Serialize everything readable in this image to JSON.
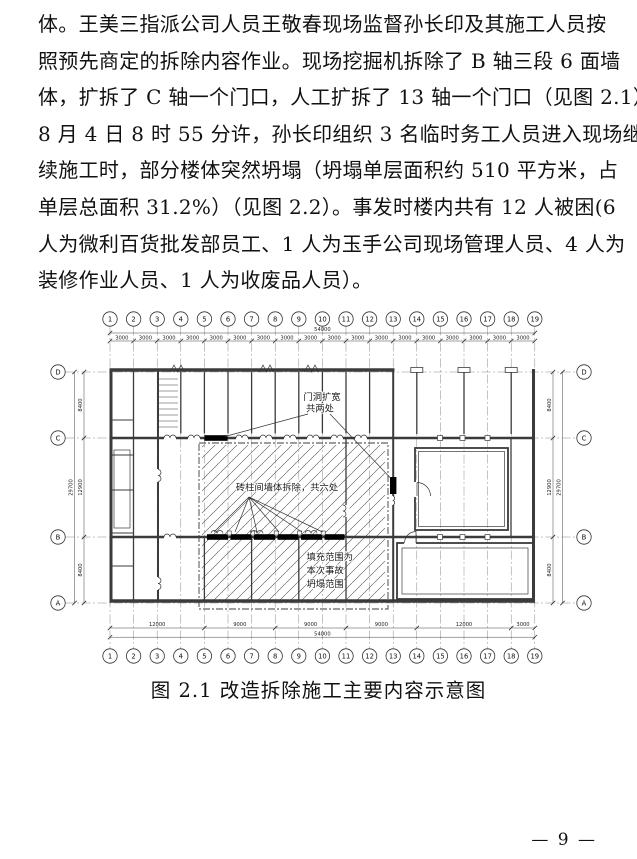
{
  "page": {
    "body_lines": [
      "体。王美三指派公司人员王敬春现场监督孙长印及其施工人员按",
      "照预先商定的拆除内容作业。现场挖掘机拆除了 B 轴三段 6 面墙",
      "体，扩拆了 C 轴一个门口，人工扩拆了 13 轴一个门口（见图 2.1）。",
      "8 月 4 日 8 时 55 分许，孙长印组织 3 名临时务工人员进入现场继",
      "续施工时，部分楼体突然坍塌（坍塌单层面积约 510 平方米，占",
      "单层总面积 31.2%）（见图 2.2）。事发时楼内共有 12 人被困(6",
      "人为微利百货批发部员工、1 人为玉手公司现场管理人员、4 人为",
      "装修作业人员、1 人为收废品人员）。"
    ],
    "figure_caption": "图 2.1 改造拆除施工主要内容示意图",
    "page_number": "— 9 —"
  },
  "diagram": {
    "column_axes": [
      "1",
      "2",
      "3",
      "4",
      "5",
      "6",
      "7",
      "8",
      "9",
      "10",
      "11",
      "12",
      "13",
      "14",
      "15",
      "16",
      "17",
      "18",
      "19"
    ],
    "row_axes": [
      "D",
      "C",
      "B",
      "A"
    ],
    "dimensions": {
      "top_total": "54000",
      "top_bays": [
        "3000",
        "3000",
        "3000",
        "3000",
        "3000",
        "3000",
        "3000",
        "3000",
        "3000",
        "3000",
        "3000",
        "3000",
        "3000",
        "3000",
        "3000",
        "3000",
        "3000",
        "3000"
      ],
      "bottom_segments": [
        "12000",
        "9000",
        "9000",
        "9000",
        "12000",
        "3000"
      ],
      "bottom_total": "54000",
      "side_segments": [
        "8400",
        "12900",
        "8400"
      ],
      "side_total": "29700"
    },
    "annotations": {
      "door_widen_line1": "门洞扩宽",
      "door_widen_line2": "共两处",
      "wall_demolition": "砖柱间墙体拆除，共六处",
      "collapse_line1": "填充范围为",
      "collapse_line2": "本次事故",
      "collapse_line3": "坍塌范围"
    },
    "colors": {
      "line": "#3b3b3b",
      "demolition_fill": "#000000"
    }
  }
}
